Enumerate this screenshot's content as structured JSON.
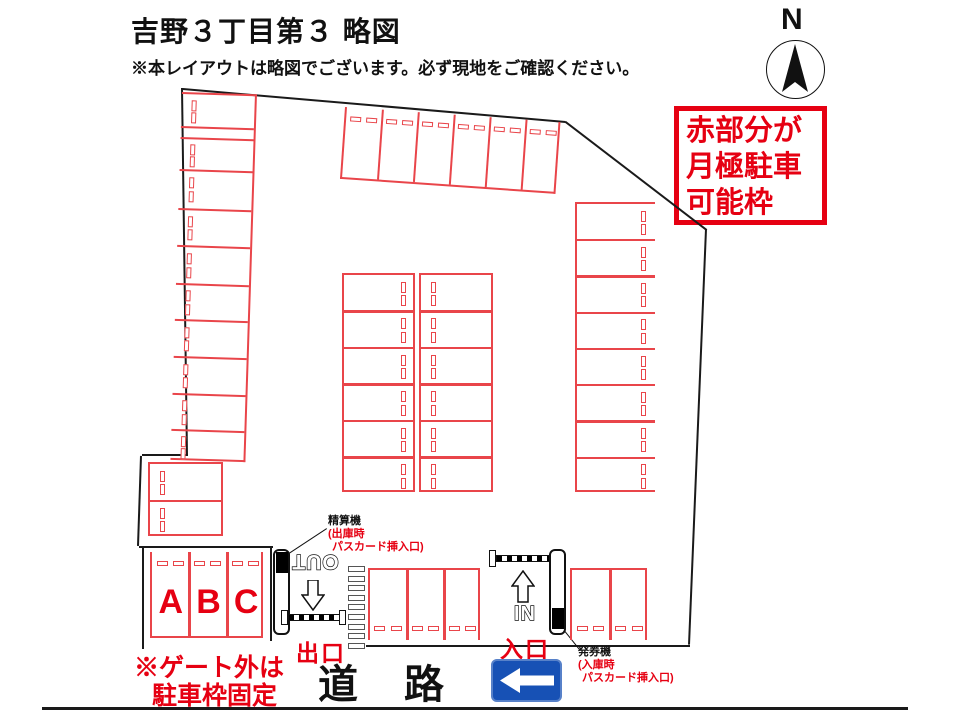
{
  "header": {
    "title": "吉野３丁目第３ 略図",
    "note": "※本レイアウトは略図でございます。必ず現地をご確認ください。"
  },
  "compass": {
    "label": "N"
  },
  "legend_box": {
    "lines": [
      "赤部分が",
      "月極駐車",
      "可能枠"
    ]
  },
  "labels": {
    "out": "OUT",
    "in": "IN",
    "exit": "出口",
    "entrance": "入口",
    "road": [
      "道",
      "路"
    ],
    "gate_note": [
      "※ゲート外は",
      "駐車枠固定"
    ],
    "pay_machine": {
      "name": "精算機",
      "sub1": "(出庫時",
      "sub2": "パスカード挿入口)"
    },
    "ticket_machine": {
      "name": "発券機",
      "sub1": "(入庫時",
      "sub2": "パスカード挿入口)"
    }
  },
  "stall_labels": [
    "A",
    "B",
    "C"
  ],
  "colors": {
    "stall_red": "#e9454a",
    "text_red": "#e60012",
    "line_black": "#1a1a1a",
    "sign_blue": "#1751b5"
  },
  "lot": {
    "boundary_lines": [
      [
        183,
        88,
        566,
        121
      ],
      [
        566,
        121,
        707,
        229
      ],
      [
        707,
        229,
        690,
        645
      ],
      [
        366,
        645,
        690,
        645
      ],
      [
        183,
        88,
        188,
        456
      ],
      [
        188,
        456,
        142,
        456
      ],
      [
        142,
        456,
        139,
        546
      ],
      [
        139,
        546,
        273,
        546
      ],
      [
        144,
        546,
        144,
        649
      ],
      [
        272,
        546,
        272,
        641
      ]
    ],
    "road_line": [
      42,
      707,
      908,
      707
    ],
    "leader_lines": [
      [
        327,
        529,
        289,
        554
      ],
      [
        580,
        651,
        564,
        631
      ]
    ],
    "crosswalk": {
      "x": 348,
      "y": 566,
      "count": 9,
      "step": 9.6,
      "w": 17,
      "h": 6
    },
    "blocks": [
      {
        "name": "left-column",
        "x": 182,
        "y": 92,
        "w": 75,
        "rows": [
          33,
          11,
          32,
          39,
          37,
          38,
          36,
          37,
          37,
          36,
          32
        ],
        "open": "left",
        "rot": 1.8
      },
      {
        "name": "top-row",
        "x": 345,
        "y": 107,
        "w": 216,
        "h": 72,
        "cols": 6,
        "open": "top",
        "rot": 4
      },
      {
        "name": "right-column",
        "x": 575,
        "y": 202,
        "w": 80,
        "h": 290,
        "rows": 8,
        "open": "right"
      },
      {
        "name": "center-left",
        "x": 342,
        "y": 273,
        "w": 73,
        "h": 219,
        "rows": 6,
        "open": "none",
        "dash": "right"
      },
      {
        "name": "center-right",
        "x": 419,
        "y": 273,
        "w": 74,
        "h": 219,
        "rows": 6,
        "open": "none",
        "dash": "left"
      },
      {
        "name": "west-pair",
        "x": 148,
        "y": 462,
        "w": 75,
        "h": 74,
        "rows": 2,
        "open": "none",
        "dash": "left"
      },
      {
        "name": "abc",
        "x": 150,
        "y": 552,
        "w": 113,
        "h": 86,
        "cols": 3,
        "open": "top",
        "letters": true
      },
      {
        "name": "exit-gate-stalls",
        "x": 368,
        "y": 568,
        "w": 112,
        "h": 72,
        "cols": 3,
        "open": "bottom"
      },
      {
        "name": "entry-gate-stalls",
        "x": 570,
        "y": 568,
        "w": 77,
        "h": 72,
        "cols": 2,
        "open": "bottom"
      }
    ]
  }
}
